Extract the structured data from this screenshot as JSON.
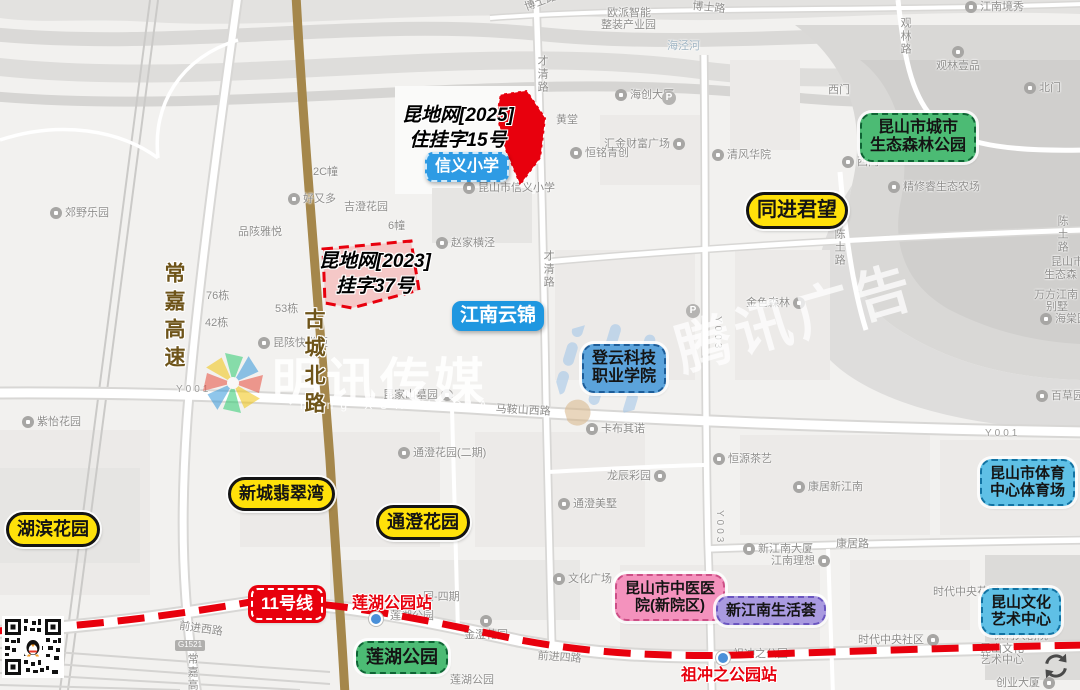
{
  "watermarks": {
    "center_text": "明讯传媒",
    "center_sub": "ming XUN MEDIA",
    "right_text": "腾讯广告"
  },
  "parcels": {
    "p2025": {
      "l1": "昆地网[2025]",
      "l2": "住挂字15号"
    },
    "p2023": {
      "l1": "昆地网[2023]",
      "l2": "挂字37号"
    }
  },
  "landmarks": [
    {
      "l1": "信义小学",
      "s": "blue-solid-dash",
      "x": 425,
      "y": 152,
      "fs": 16
    },
    {
      "l1": "江南云锦",
      "s": "blue-solid",
      "x": 452,
      "y": 301,
      "fs": 19
    },
    {
      "l1": "登云科技",
      "l2": "职业学院",
      "s": "blue-mid",
      "x": 582,
      "y": 344,
      "fs": 16
    },
    {
      "l1": "昆山市城市",
      "l2": "生态森林公园",
      "s": "green",
      "x": 860,
      "y": 113,
      "fs": 16
    },
    {
      "l1": "同进君望",
      "s": "yellow",
      "x": 746,
      "y": 192,
      "fs": 20
    },
    {
      "l1": "昆山市体育",
      "l2": "中心体育场",
      "s": "blue-light",
      "x": 980,
      "y": 459,
      "fs": 15
    },
    {
      "l1": "昆山文化",
      "l2": "艺术中心",
      "s": "blue-light",
      "x": 981,
      "y": 588,
      "fs": 15
    },
    {
      "l1": "昆山市中医医",
      "l2": "院(新院区)",
      "s": "pink",
      "x": 615,
      "y": 574,
      "fs": 15
    },
    {
      "l1": "新江南生活荟",
      "s": "purple",
      "x": 716,
      "y": 596,
      "fs": 15
    },
    {
      "l1": "新城翡翠湾",
      "s": "yellow",
      "x": 228,
      "y": 477,
      "fs": 17
    },
    {
      "l1": "通澄花园",
      "s": "yellow",
      "x": 376,
      "y": 505,
      "fs": 18
    },
    {
      "l1": "湖滨花园",
      "s": "yellow",
      "x": 6,
      "y": 512,
      "fs": 18
    },
    {
      "l1": "莲湖公园",
      "s": "green",
      "x": 356,
      "y": 641,
      "fs": 18
    },
    {
      "l1": "11号线",
      "s": "metro",
      "x": 251,
      "y": 588,
      "fs": 17
    }
  ],
  "road_names": [
    {
      "t": "常嘉高速",
      "x": 163,
      "y": 262
    },
    {
      "t": "古城北路",
      "x": 303,
      "y": 308
    }
  ],
  "metro": {
    "station_labels": [
      {
        "t": "莲湖公园站",
        "x": 352,
        "y": 589
      },
      {
        "t": "祖冲之公园站",
        "x": 681,
        "y": 661
      }
    ],
    "station_dots": [
      {
        "x": 369,
        "y": 612
      },
      {
        "x": 716,
        "y": 651
      }
    ]
  },
  "parking_label": "P",
  "parking_icons": [
    {
      "x": 662,
      "y": 91
    },
    {
      "x": 686,
      "y": 304
    }
  ],
  "map_labels": [
    {
      "t": "博士路",
      "x": 523,
      "y": 2,
      "r": -20
    },
    {
      "t": "博士路",
      "x": 693,
      "y": 0,
      "r": 6
    },
    {
      "t": "欧派智能",
      "x": 607,
      "y": 7
    },
    {
      "t": "整装产业园",
      "x": 601,
      "y": 19
    },
    {
      "t": "海泾河",
      "x": 667,
      "y": 40,
      "cls": "water"
    },
    {
      "t": "才清路",
      "x": 536,
      "y": 55,
      "v": 1
    },
    {
      "t": "才清路",
      "x": 542,
      "y": 250,
      "v": 1
    },
    {
      "t": "江南境秀",
      "x": 965,
      "y": 1,
      "m": "l"
    },
    {
      "t": "观林路",
      "x": 899,
      "y": 17,
      "v": 1
    },
    {
      "t": "观林壹品",
      "x": 936,
      "y": 60,
      "m": "a"
    },
    {
      "t": "北门",
      "x": 1024,
      "y": 82,
      "m": "l"
    },
    {
      "t": "西门",
      "x": 828,
      "y": 84
    },
    {
      "t": "西门",
      "x": 842,
      "y": 156,
      "m": "l"
    },
    {
      "t": "清风华院",
      "x": 712,
      "y": 149,
      "m": "l"
    },
    {
      "t": "精修睿生态农场",
      "x": 888,
      "y": 181,
      "m": "l"
    },
    {
      "t": "海创大厦",
      "x": 615,
      "y": 89,
      "m": "l"
    },
    {
      "t": "黄堂",
      "x": 556,
      "y": 114
    },
    {
      "t": "汇金财富广场",
      "x": 604,
      "y": 138,
      "m": "r"
    },
    {
      "t": "恒铭青创",
      "x": 570,
      "y": 147,
      "m": "l"
    },
    {
      "t": "昆山市信义小学",
      "x": 463,
      "y": 182,
      "m": "l"
    },
    {
      "t": "赵家横泾",
      "x": 436,
      "y": 237,
      "m": "l"
    },
    {
      "t": "6幢",
      "x": 388,
      "y": 220
    },
    {
      "t": "2C幢",
      "x": 313,
      "y": 166
    },
    {
      "t": "郊野乐园",
      "x": 50,
      "y": 207,
      "m": "l"
    },
    {
      "t": "好又多",
      "x": 288,
      "y": 193,
      "m": "l"
    },
    {
      "t": "品陔雅悦",
      "x": 238,
      "y": 226
    },
    {
      "t": "吉澄花园",
      "x": 344,
      "y": 201
    },
    {
      "t": "76栋",
      "x": 206,
      "y": 290
    },
    {
      "t": "42栋",
      "x": 205,
      "y": 317
    },
    {
      "t": "53栋",
      "x": 275,
      "y": 303
    },
    {
      "t": "昆陔快递柜",
      "x": 258,
      "y": 337,
      "m": "l"
    },
    {
      "t": "Y001",
      "x": 176,
      "y": 384,
      "cls": "roadnum"
    },
    {
      "t": "Y001",
      "x": 985,
      "y": 428,
      "cls": "roadnum"
    },
    {
      "t": "昆家山墓园",
      "x": 383,
      "y": 389,
      "m": "r"
    },
    {
      "t": "马鞍山西路",
      "x": 496,
      "y": 403,
      "r": 3
    },
    {
      "t": "卡布其诺",
      "x": 586,
      "y": 423,
      "m": "l"
    },
    {
      "t": "通澄花园(二期)",
      "x": 398,
      "y": 447,
      "m": "l"
    },
    {
      "t": "龙辰彩园",
      "x": 607,
      "y": 470,
      "m": "r"
    },
    {
      "t": "通澄美墅",
      "x": 558,
      "y": 498,
      "m": "l"
    },
    {
      "t": "金色森林",
      "x": 746,
      "y": 297,
      "m": "r"
    },
    {
      "t": "Y003",
      "x": 712,
      "y": 316,
      "v": 1,
      "cls": "roadnum"
    },
    {
      "t": "Y003",
      "x": 714,
      "y": 510,
      "v": 1,
      "cls": "roadnum"
    },
    {
      "t": "恒源茶艺",
      "x": 713,
      "y": 453,
      "m": "l"
    },
    {
      "t": "康居新江南",
      "x": 793,
      "y": 481,
      "m": "l"
    },
    {
      "t": "新江南大厦",
      "x": 743,
      "y": 543,
      "m": "l"
    },
    {
      "t": "康居路",
      "x": 836,
      "y": 538
    },
    {
      "t": "江南理想",
      "x": 771,
      "y": 555,
      "m": "r"
    },
    {
      "t": "海棠园",
      "x": 1040,
      "y": 313,
      "m": "l"
    },
    {
      "t": "万方江南",
      "x": 1034,
      "y": 289
    },
    {
      "t": "别墅",
      "x": 1046,
      "y": 301
    },
    {
      "t": "昆山市",
      "x": 1051,
      "y": 256
    },
    {
      "t": "生态森",
      "x": 1044,
      "y": 269
    },
    {
      "t": "陈土路",
      "x": 833,
      "y": 228,
      "v": 1
    },
    {
      "t": "陈土路",
      "x": 1056,
      "y": 215,
      "v": 1
    },
    {
      "t": "百草园",
      "x": 1036,
      "y": 390,
      "m": "l"
    },
    {
      "t": "紫怡花园",
      "x": 22,
      "y": 416,
      "m": "l"
    },
    {
      "t": "文化广场",
      "x": 553,
      "y": 573,
      "m": "l"
    },
    {
      "t": "金澄花园",
      "x": 464,
      "y": 629,
      "m": "a"
    },
    {
      "t": "莲湖公园",
      "x": 450,
      "y": 674
    },
    {
      "t": "莲湖公园",
      "x": 390,
      "y": 610
    },
    {
      "t": "园-四期",
      "x": 423,
      "y": 591
    },
    {
      "t": "前进西路",
      "x": 180,
      "y": 620,
      "r": 8
    },
    {
      "t": "G1521",
      "x": 175,
      "y": 640,
      "cls": "shield"
    },
    {
      "t": "常嘉高速",
      "x": 186,
      "y": 653,
      "v": 1
    },
    {
      "t": "前进四路",
      "x": 538,
      "y": 650,
      "r": 4
    },
    {
      "t": "祖冲之公园",
      "x": 733,
      "y": 648
    },
    {
      "t": "时代中央社区",
      "x": 858,
      "y": 634,
      "m": "r"
    },
    {
      "t": "时代中央花园",
      "x": 933,
      "y": 586
    },
    {
      "t": "保利大剧院",
      "x": 993,
      "y": 630
    },
    {
      "t": "昆山文化",
      "x": 980,
      "y": 643
    },
    {
      "t": "艺术中心",
      "x": 980,
      "y": 654
    },
    {
      "t": "创业大厦",
      "x": 996,
      "y": 677,
      "m": "r"
    }
  ]
}
